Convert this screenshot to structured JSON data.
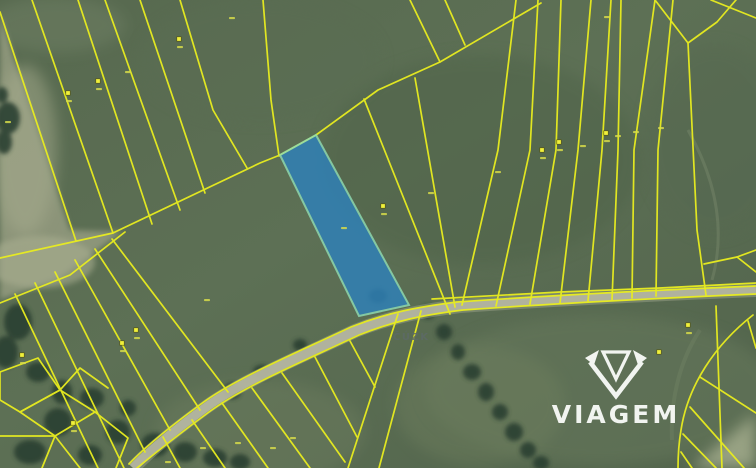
{
  "brand": {
    "wordmark": "VIAGEM"
  },
  "map": {
    "attribution": "ČÚZK",
    "colors": {
      "parcel_line": "#e9ed1f",
      "selected_parcel_fill": "#2e81ba",
      "selected_parcel_border": "#8fdcb4",
      "road_fill": "#b6b7a3",
      "attribution_text": "#5d6a66",
      "watermark_text": "#f8faf7"
    },
    "markers": [
      {
        "x": 179,
        "y": 39
      },
      {
        "x": 98,
        "y": 81
      },
      {
        "x": 68,
        "y": 93
      },
      {
        "x": 383,
        "y": 206
      },
      {
        "x": 542,
        "y": 150
      },
      {
        "x": 559,
        "y": 142
      },
      {
        "x": 606,
        "y": 133
      },
      {
        "x": 136,
        "y": 330
      },
      {
        "x": 122,
        "y": 343
      },
      {
        "x": 22,
        "y": 355
      },
      {
        "x": 73,
        "y": 423
      },
      {
        "x": 688,
        "y": 325
      },
      {
        "x": 659,
        "y": 352
      }
    ],
    "number_marks": [
      {
        "x": 180,
        "y": 47
      },
      {
        "x": 99,
        "y": 89
      },
      {
        "x": 69,
        "y": 101
      },
      {
        "x": 8,
        "y": 122
      },
      {
        "x": 128,
        "y": 72
      },
      {
        "x": 232,
        "y": 18
      },
      {
        "x": 384,
        "y": 214
      },
      {
        "x": 543,
        "y": 158
      },
      {
        "x": 560,
        "y": 150
      },
      {
        "x": 607,
        "y": 141
      },
      {
        "x": 607,
        "y": 17
      },
      {
        "x": 498,
        "y": 172
      },
      {
        "x": 431,
        "y": 193
      },
      {
        "x": 583,
        "y": 146
      },
      {
        "x": 618,
        "y": 136
      },
      {
        "x": 636,
        "y": 132
      },
      {
        "x": 661,
        "y": 128
      },
      {
        "x": 207,
        "y": 300
      },
      {
        "x": 344,
        "y": 228
      },
      {
        "x": 137,
        "y": 338
      },
      {
        "x": 123,
        "y": 351
      },
      {
        "x": 23,
        "y": 363
      },
      {
        "x": 74,
        "y": 431
      },
      {
        "x": 689,
        "y": 333
      },
      {
        "x": 168,
        "y": 462
      },
      {
        "x": 203,
        "y": 448
      },
      {
        "x": 238,
        "y": 443
      },
      {
        "x": 273,
        "y": 448
      },
      {
        "x": 293,
        "y": 438
      }
    ]
  }
}
